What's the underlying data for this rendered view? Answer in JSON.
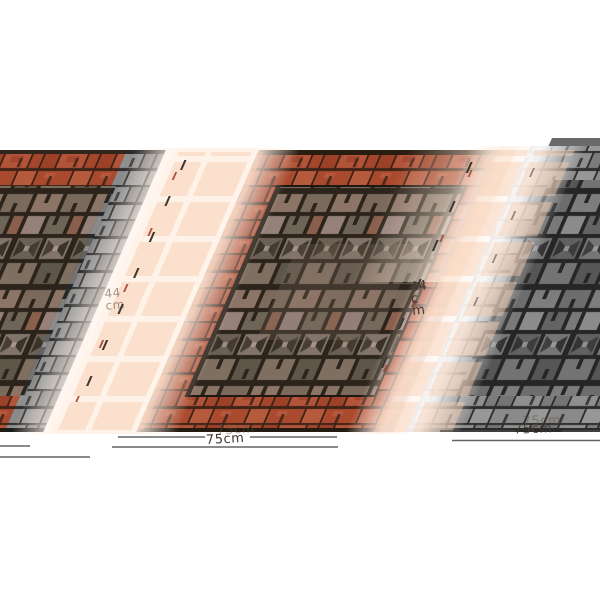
{
  "image": {
    "subject": "Brick and mosaic pattern rubber doormat product photo, angled perspective view on white background, flanked by grayscale partial copies",
    "dimension_labels": {
      "depth_left": "44cm",
      "depth_right": "44cm",
      "width_center": "75cm",
      "width_right": "75cm"
    },
    "colors": {
      "background": "#ffffff",
      "brick_red": "#a94a2e",
      "brick_red_dark": "#8f3a22",
      "brick_red_light": "#b65a3e",
      "mosaic_taupe": "#8c7466",
      "mosaic_mauve": "#95807a",
      "mosaic_gray_green": "#6e6457",
      "grout_dark": "#2c241b",
      "grayscale_brick": "#7b7b7b",
      "wash_pink": "#f6dfd2",
      "ghost_peach": "#f6cdb0",
      "dimension_line": "#4a4a4a",
      "dimension_red_tick": "#a03a28",
      "label_text": "#403830"
    }
  }
}
